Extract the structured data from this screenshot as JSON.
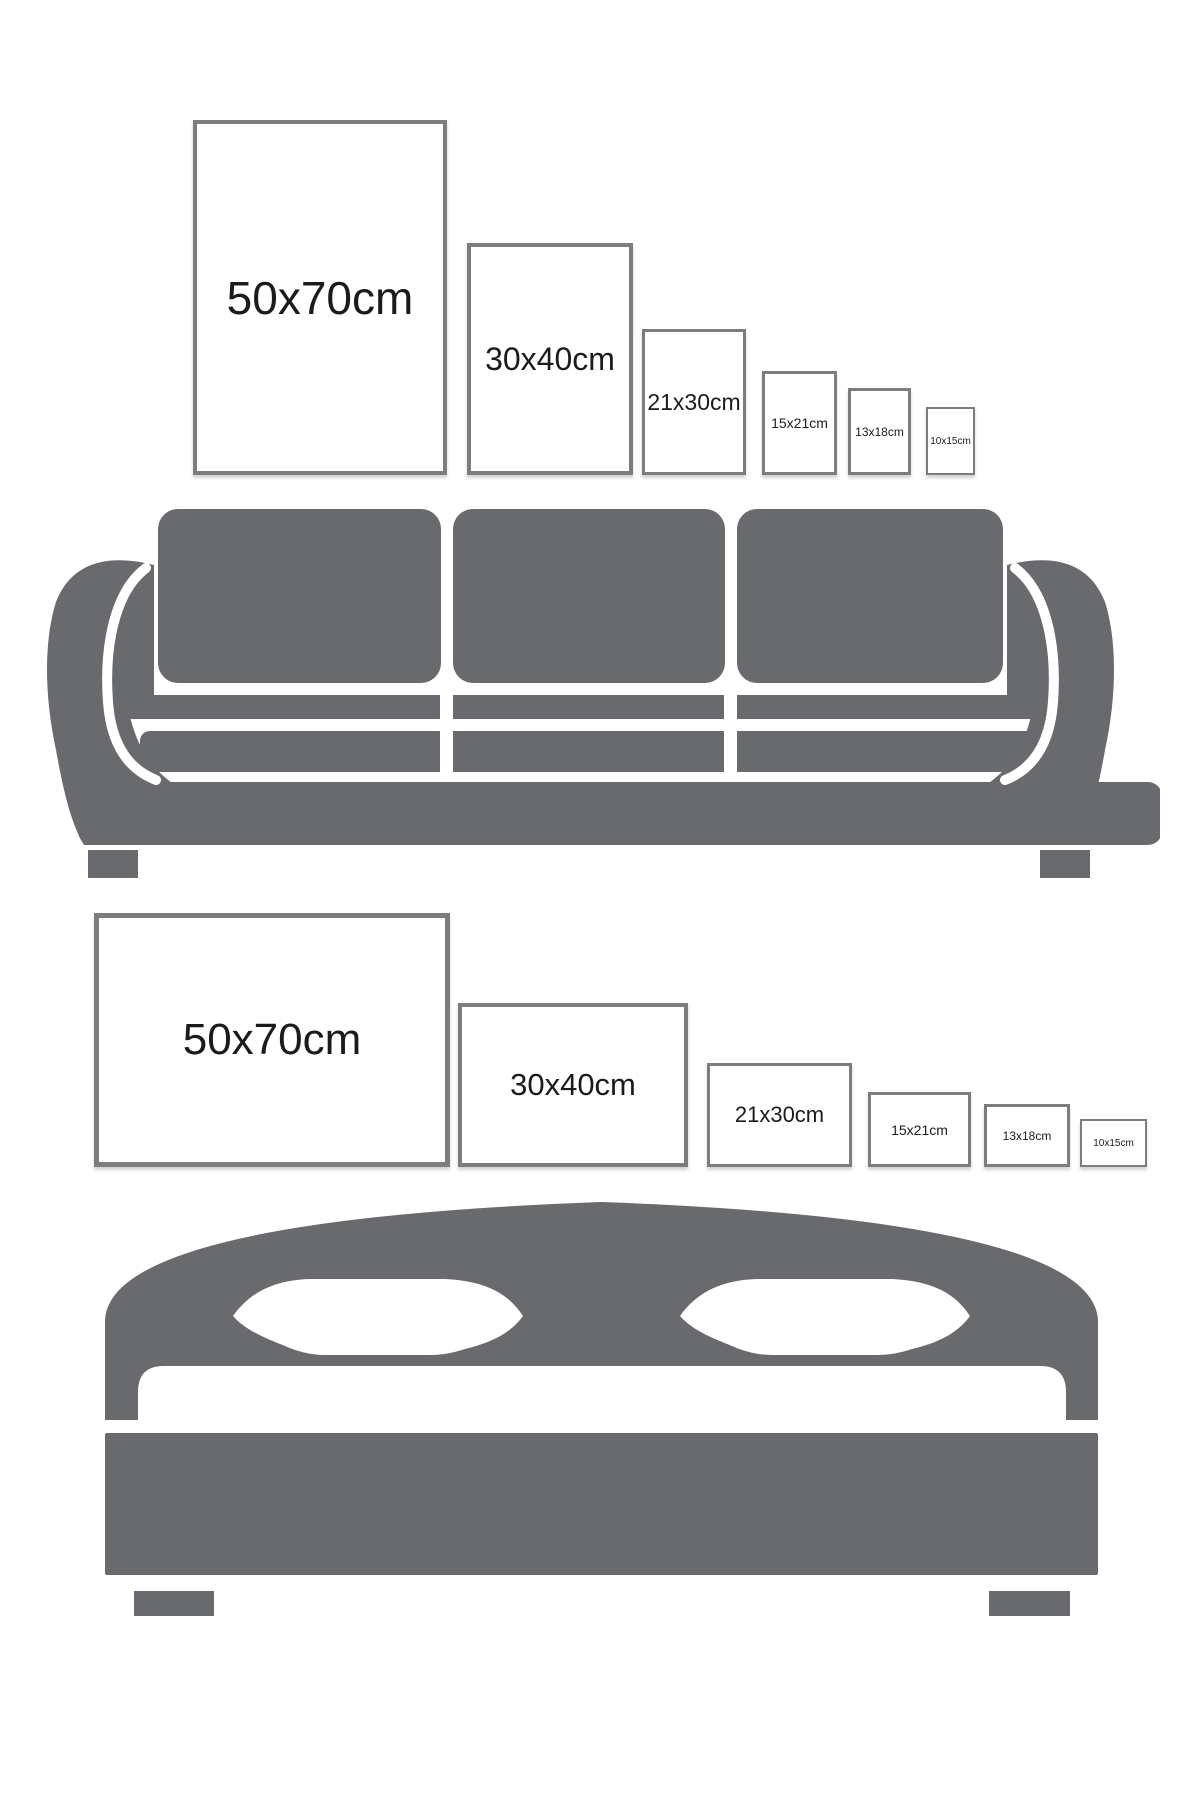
{
  "colors": {
    "background": "#ffffff",
    "furniture_gray": "#696a6d",
    "frame_border": "#7b7d7f",
    "label_text": "#1b1b1b"
  },
  "top_row": {
    "furniture": "sofa",
    "orientation": "portrait",
    "frames": [
      {
        "label": "50x70cm"
      },
      {
        "label": "30x40cm"
      },
      {
        "label": "21x30cm"
      },
      {
        "label": "15x21cm"
      },
      {
        "label": "13x18cm"
      },
      {
        "label": "10x15cm"
      }
    ]
  },
  "bottom_row": {
    "furniture": "bed",
    "orientation": "landscape",
    "frames": [
      {
        "label": "50x70cm"
      },
      {
        "label": "30x40cm"
      },
      {
        "label": "21x30cm"
      },
      {
        "label": "15x21cm"
      },
      {
        "label": "13x18cm"
      },
      {
        "label": "10x15cm"
      }
    ]
  }
}
